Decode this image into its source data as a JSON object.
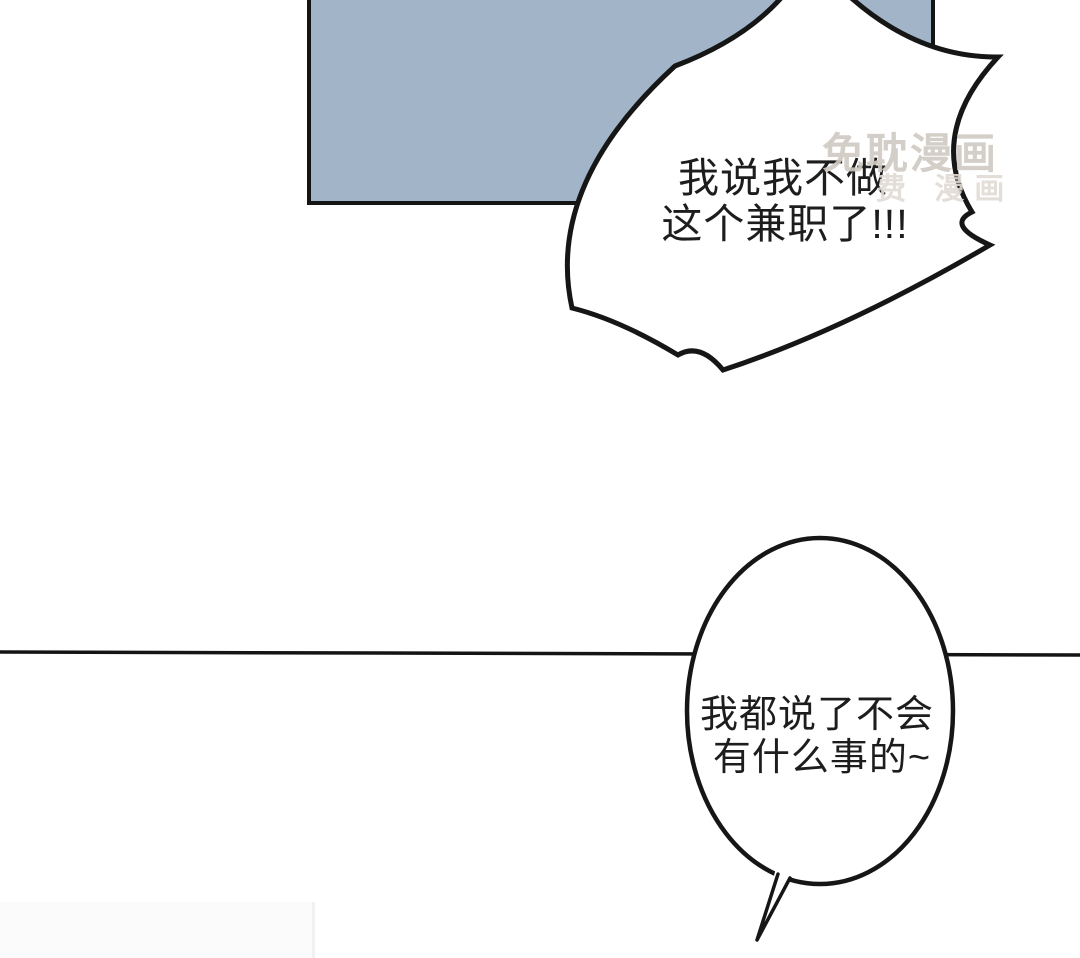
{
  "page": {
    "type": "webtoon-comic-panel",
    "background": "#ffffff"
  },
  "panel": {
    "fill": "#a1b4c8",
    "stroke": "#141414"
  },
  "divider": {
    "color": "#141414"
  },
  "bubbles": {
    "shout": {
      "shape": "spiky-burst",
      "line1": "我说我不做",
      "line2": "这个兼职了!!!"
    },
    "calm": {
      "shape": "oval-with-tail",
      "line1": "我都说了不会",
      "line2": "有什么事的~"
    }
  },
  "watermark": {
    "title": "免耽漫画",
    "subtitle": "费 漫画",
    "title_color": "#cfc9c1",
    "subtitle_color": "#e0dbd4"
  }
}
